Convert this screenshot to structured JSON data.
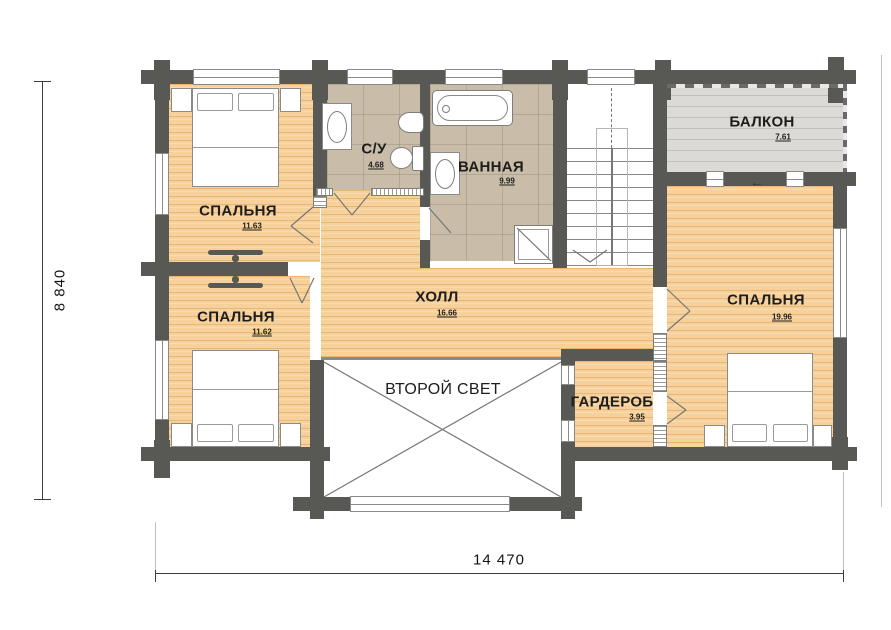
{
  "rooms": {
    "bedroom_top_left": {
      "name": "СПАЛЬНЯ",
      "area": "11.63"
    },
    "bedroom_bottom_left": {
      "name": "СПАЛЬНЯ",
      "area": "11.62"
    },
    "bedroom_right": {
      "name": "СПАЛЬНЯ",
      "area": "19.96"
    },
    "wc": {
      "name": "С/У",
      "area": "4.68"
    },
    "bathroom": {
      "name": "ВАННАЯ",
      "area": "9.99"
    },
    "hall": {
      "name": "ХОЛЛ",
      "area": "16.66"
    },
    "balcony": {
      "name": "БАЛКОН",
      "area": "7.61"
    },
    "wardrobe": {
      "name": "ГАРДЕРОБ",
      "area": "3.95"
    },
    "second_light": {
      "name": "ВТОРОЙ СВЕТ"
    }
  },
  "dimensions": {
    "width": "14 470",
    "height": "8 840"
  },
  "symbols": {
    "balcony_exit_arrow": "←"
  },
  "colors": {
    "wall": "#585855",
    "wood_floor": "#f7d19c",
    "tile_floor": "#c9bdaa",
    "balcony_floor": "#dbdad6"
  }
}
